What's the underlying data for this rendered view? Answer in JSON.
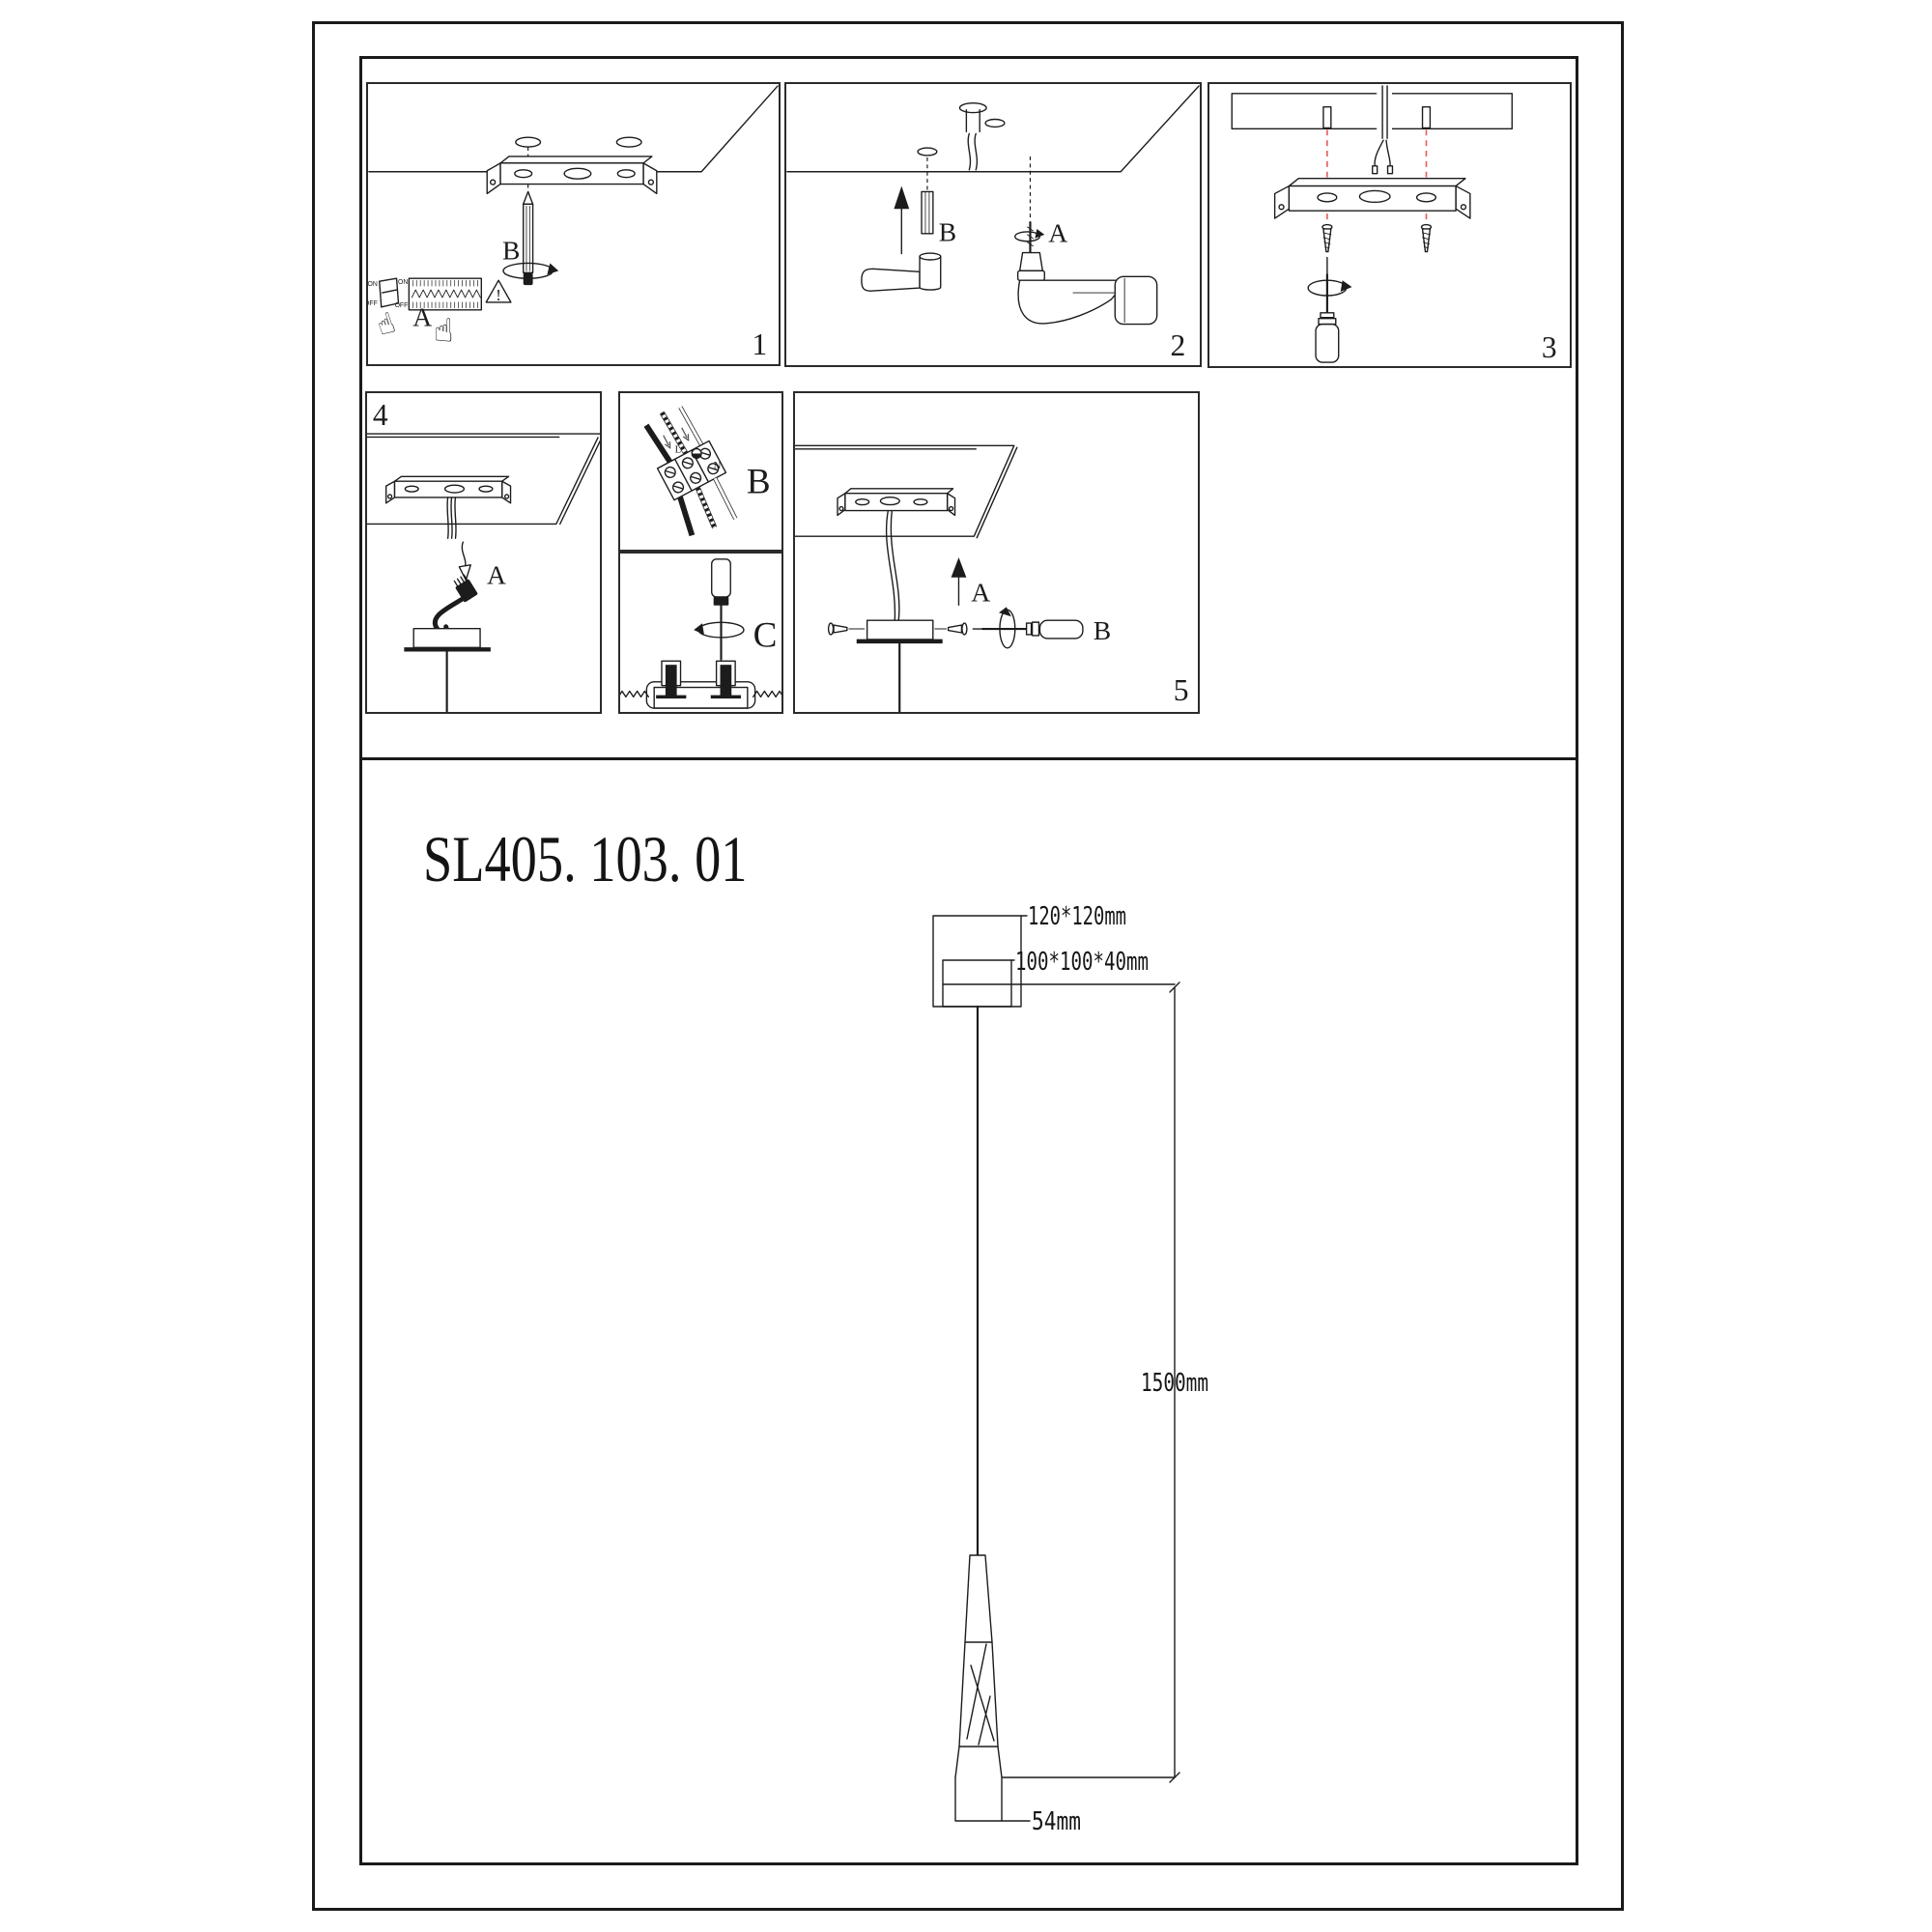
{
  "title": {
    "model": "SL405. 103. 01"
  },
  "panels": {
    "p1": {
      "num": "1",
      "a": "A",
      "b": "B",
      "sw_on": "ON",
      "sw_off": "OFF",
      "strip_on": "ON",
      "strip_off": "OFF",
      "warn": "!"
    },
    "p2": {
      "num": "2",
      "a": "A",
      "b": "B"
    },
    "p3": {
      "num": "3"
    },
    "p4": {
      "num": "4",
      "a": "A"
    },
    "p5": {
      "num": "5",
      "a": "A",
      "b": "B"
    },
    "b_detail": {
      "letter": "B",
      "live": "L",
      "neutral": "N"
    },
    "c_detail": {
      "letter": "C"
    }
  },
  "dims": {
    "plate": "120*120mm",
    "canopy": "100*100*40mm",
    "cable": "1500mm",
    "shade": "54mm"
  },
  "colors": {
    "line": "#1c1c1c",
    "guide_red": "#e86060"
  }
}
